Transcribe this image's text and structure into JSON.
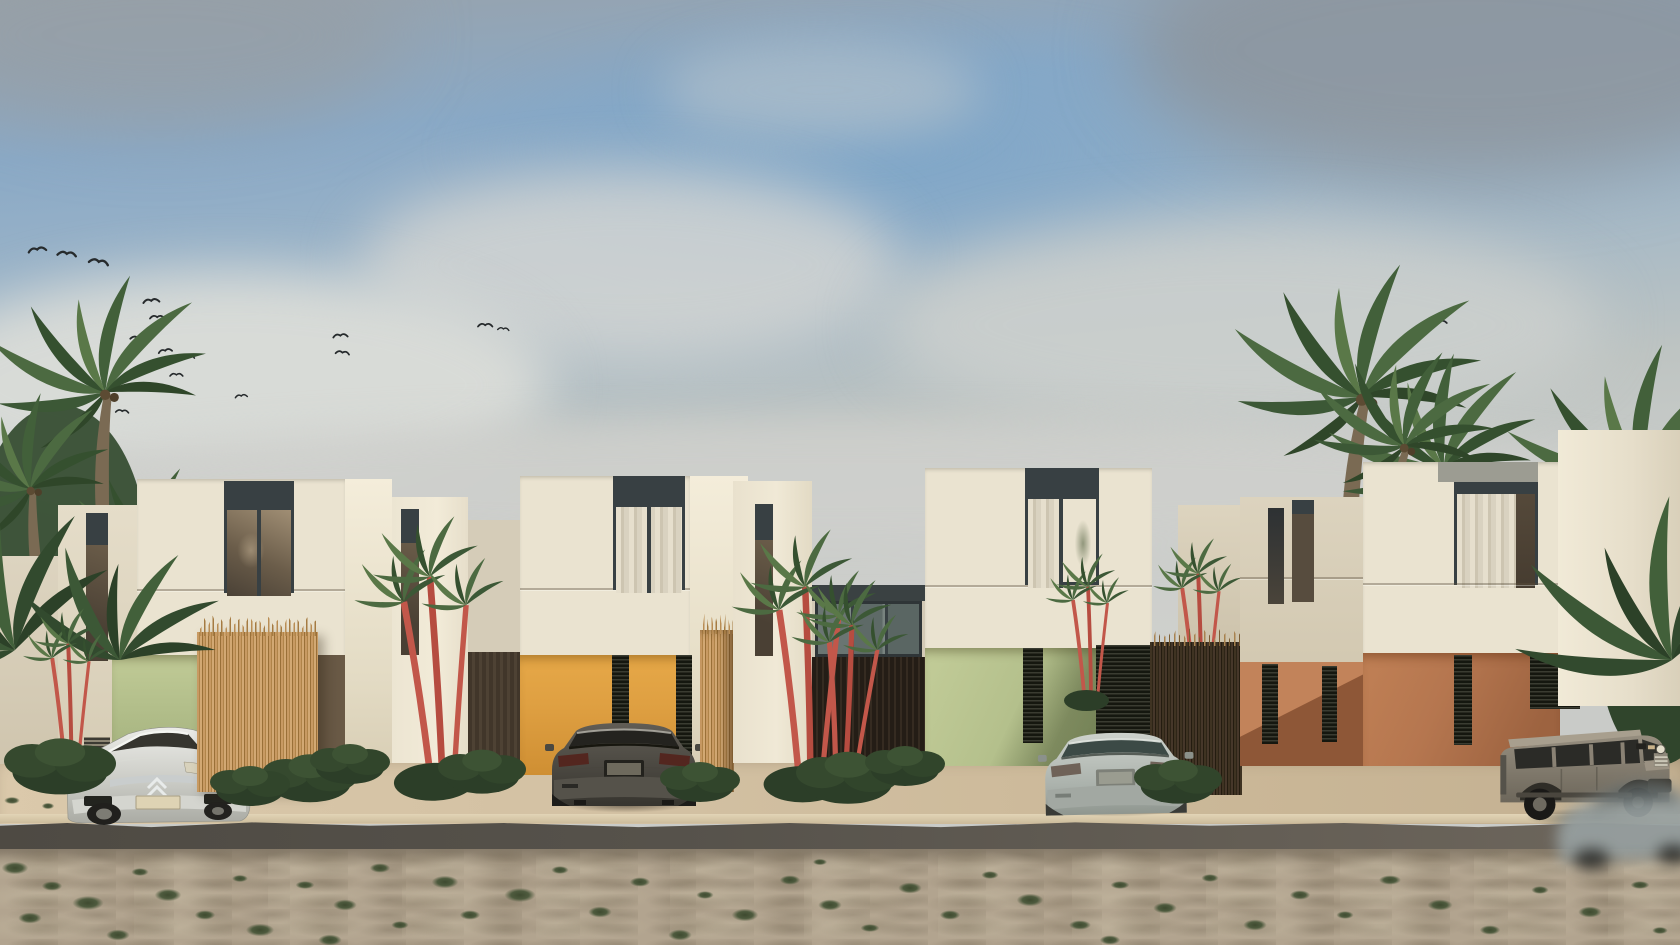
{
  "meta": {
    "title": "Street-facing architectural rendering of four modern two-story villas",
    "style": "photorealistic exterior visualization",
    "setting": "tropical street with palms, sandy verge and parked cars",
    "camera": "street-level front elevation"
  },
  "colors": {
    "sky_blue": "#7fa6c8",
    "cloud": "#cfd1ce",
    "cream": "#eae3d0",
    "cream_bright": "#f4edda",
    "cream_shade": "#d8cfba",
    "frame": "#384043",
    "glass": "#7c6d59",
    "curtain": "#ded7c5",
    "sage": "#b3bf8b",
    "amber": "#dfa042",
    "terracotta": "#b5764f",
    "terracotta_deep": "#8e5737",
    "terracotta_lit": "#c2835a",
    "woven": "#c0925c",
    "fence_dark": "#3a2f21",
    "palm": "#4c6a41",
    "stem": "#c2574a",
    "apron": "#d5c3a5",
    "curb": "#e2d4b6",
    "road": "#56524b",
    "sand": "#b2a48f",
    "grass": "#49573a",
    "car_white": "#dfe0da",
    "car_charcoal": "#504d46",
    "car_silver": "#bcc1bc",
    "car_stone": "#8e8678"
  },
  "sky": {
    "cloud_cover": "scattered soft clouds, blue patch upper center, gray corners",
    "birds": [
      [
        28,
        247,
        1.1,
        -8
      ],
      [
        58,
        249,
        1.15,
        5
      ],
      [
        90,
        256,
        1.2,
        10
      ],
      [
        143,
        298,
        1.0,
        -5
      ],
      [
        150,
        314,
        0.9,
        0
      ],
      [
        131,
        334,
        0.95,
        8
      ],
      [
        158,
        349,
        0.85,
        -10
      ],
      [
        182,
        353,
        0.8,
        5
      ],
      [
        170,
        372,
        0.8,
        0
      ],
      [
        235,
        394,
        0.75,
        -6
      ],
      [
        116,
        408,
        0.8,
        4
      ],
      [
        333,
        333,
        0.9,
        -4
      ],
      [
        336,
        349,
        0.85,
        6
      ],
      [
        478,
        322,
        0.9,
        0
      ],
      [
        498,
        326,
        0.7,
        5
      ],
      [
        1432,
        320,
        0.9,
        -6
      ]
    ]
  },
  "houses": [
    {
      "name": "villa-1",
      "ground_floor_accent": "sage-green",
      "accent_hex": "#b3bf8b",
      "upper": "cream stucco, dark-framed window with bronze glass",
      "screen": "woven palm privacy screen",
      "vehicle": "white hatchback"
    },
    {
      "name": "villa-2",
      "ground_floor_accent": "amber-ochre",
      "accent_hex": "#dfa042",
      "upper": "cream stucco, curtained window",
      "screen": "woven palm privacy screen",
      "vehicle": "charcoal SUV coupe"
    },
    {
      "name": "villa-3",
      "ground_floor_accent": "sage-green",
      "accent_hex": "#b3bf8b",
      "upper": "cream stucco, curtained corner window",
      "screen": "dark woven screen",
      "vehicle": "silver sedan"
    },
    {
      "name": "villa-4",
      "ground_floor_accent": "terracotta",
      "accent_hex": "#b5764f",
      "upper": "cream stucco, curtained sliding window",
      "screen": "dark woven screen",
      "vehicle": "stone-gray off-road SUV"
    }
  ],
  "vehicles": [
    {
      "type": "hatchback",
      "color": "white-silver",
      "position": "villa-1 driveway",
      "view": "front three-quarter"
    },
    {
      "type": "suv-coupe",
      "color": "charcoal gray",
      "position": "villa-2 driveway",
      "view": "rear"
    },
    {
      "type": "sedan",
      "color": "silver",
      "position": "villa-3 driveway",
      "view": "rear three-quarter"
    },
    {
      "type": "offroad-suv",
      "color": "stone gray",
      "position": "villa-4 driveway",
      "view": "front three-quarter"
    },
    {
      "type": "passing-car",
      "color": "gray",
      "position": "street, bottom right",
      "motion": "blurred"
    }
  ],
  "vegetation": {
    "background_palms": 8,
    "red_stem_palms": 5,
    "shrubs": 10,
    "notes": "coconut palms behind left and right edges, lipstick palms between villas, low shrubs at plot edges"
  },
  "ground": {
    "surfaces": [
      "light concrete parking apron",
      "dark asphalt street edge",
      "sand verge with grass tufts"
    ],
    "grass_tufts": [
      [
        15,
        868,
        34
      ],
      [
        52,
        886,
        26
      ],
      [
        88,
        903,
        40
      ],
      [
        30,
        918,
        30
      ],
      [
        140,
        872,
        22
      ],
      [
        168,
        895,
        34
      ],
      [
        205,
        915,
        26
      ],
      [
        240,
        878,
        20
      ],
      [
        118,
        935,
        30
      ],
      [
        260,
        930,
        36
      ],
      [
        305,
        885,
        24
      ],
      [
        345,
        905,
        30
      ],
      [
        380,
        868,
        26
      ],
      [
        400,
        925,
        22
      ],
      [
        445,
        882,
        34
      ],
      [
        470,
        915,
        26
      ],
      [
        520,
        895,
        40
      ],
      [
        560,
        870,
        22
      ],
      [
        600,
        912,
        30
      ],
      [
        640,
        882,
        26
      ],
      [
        680,
        935,
        30
      ],
      [
        705,
        895,
        22
      ],
      [
        745,
        915,
        34
      ],
      [
        790,
        880,
        26
      ],
      [
        830,
        905,
        30
      ],
      [
        870,
        928,
        24
      ],
      [
        910,
        888,
        30
      ],
      [
        950,
        915,
        26
      ],
      [
        990,
        875,
        22
      ],
      [
        1030,
        900,
        34
      ],
      [
        1080,
        925,
        28
      ],
      [
        1120,
        885,
        24
      ],
      [
        1165,
        908,
        30
      ],
      [
        1210,
        878,
        22
      ],
      [
        1255,
        925,
        30
      ],
      [
        1300,
        895,
        26
      ],
      [
        1345,
        915,
        22
      ],
      [
        1390,
        880,
        28
      ],
      [
        1440,
        905,
        32
      ],
      [
        1490,
        930,
        26
      ],
      [
        1540,
        890,
        22
      ],
      [
        1590,
        912,
        30
      ],
      [
        1640,
        885,
        24
      ],
      [
        1660,
        930,
        20
      ],
      [
        330,
        940,
        30
      ],
      [
        820,
        862,
        18
      ],
      [
        1110,
        940,
        26
      ],
      [
        12,
        800,
        20
      ],
      [
        48,
        806,
        16
      ]
    ]
  }
}
